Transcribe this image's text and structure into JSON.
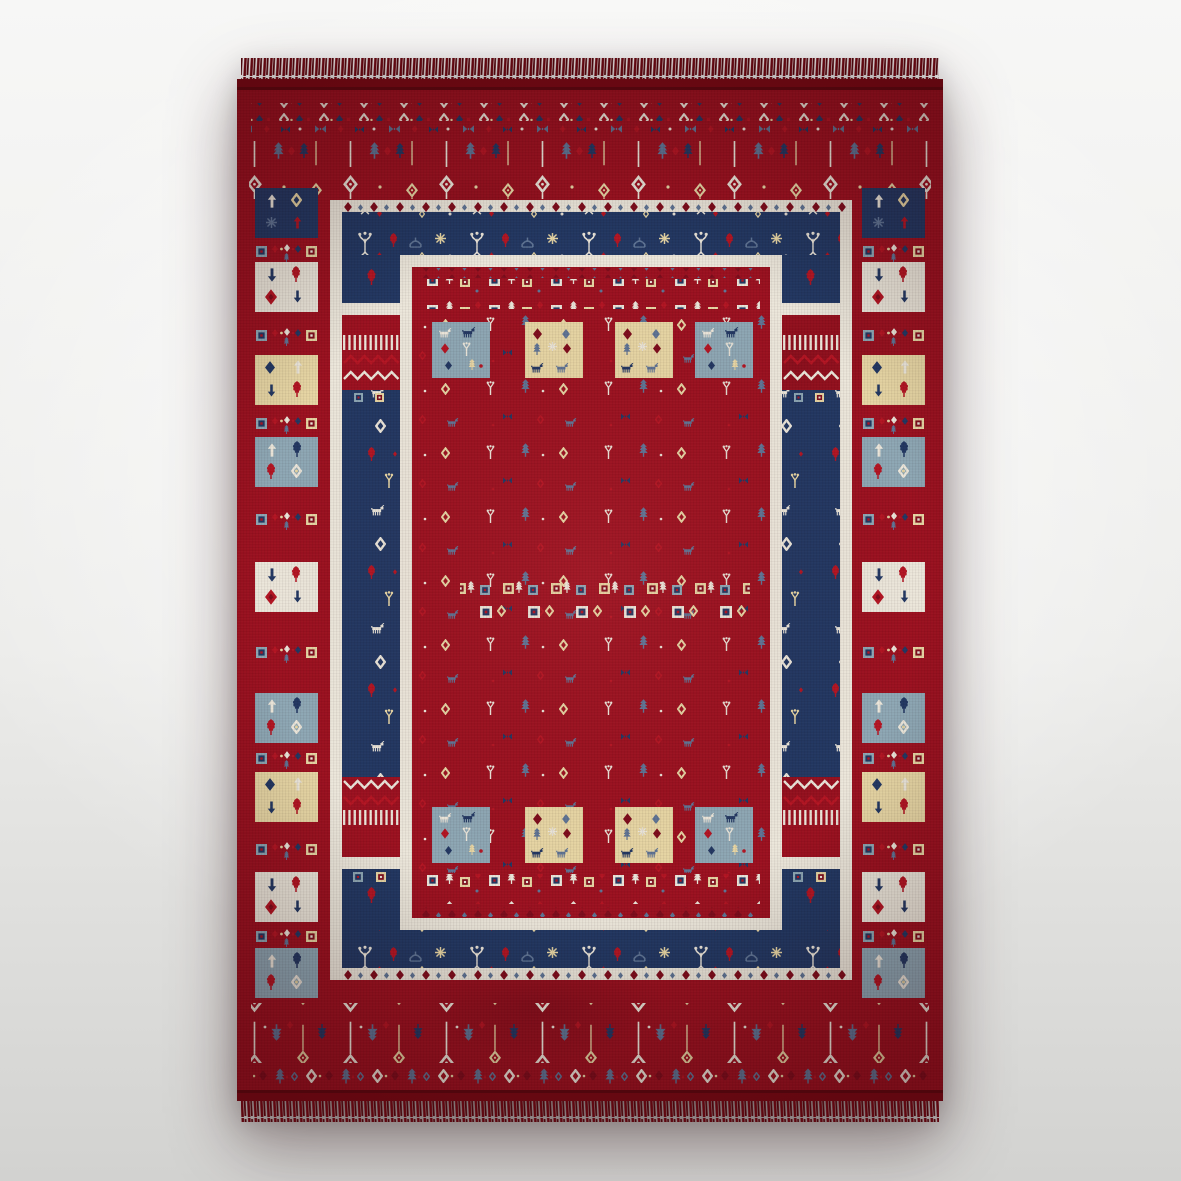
{
  "image": {
    "type": "product-photo",
    "subject": "Red gabbeh-style tribal area rug with navy stepped inner frame, patchwork side squares, animal and plant motifs, and fringed ends",
    "background": "light studio gradient backdrop"
  },
  "palette": {
    "bg_top": "#f7f7f6",
    "bg_mid": "#ececea",
    "bg_bottom": "#d2d2d0",
    "red": "#9c1120",
    "red_light": "#b02331",
    "red_deep": "#7c0b16",
    "maroon": "#7f0d1c",
    "navy": "#2238633",
    "ivory": "#ece7db",
    "cream": "#e8d7a5",
    "bluegray": "#8ea8b5",
    "slate": "#5f7596",
    "accent": "#b41523",
    "fringe": "#5f0710",
    "selvedge": "#7b0a15"
  },
  "rug": {
    "left_panel_squares": [
      "navy",
      "ivory",
      "cream",
      "blue-gray",
      "ivory",
      "blue-gray",
      "cream",
      "ivory",
      "blue-gray"
    ],
    "right_panel_squares": [
      "navy",
      "ivory",
      "cream",
      "blue-gray",
      "ivory",
      "blue-gray",
      "cream",
      "ivory",
      "blue-gray"
    ],
    "inner_top_squares": [
      "blue-gray",
      "cream",
      "cream",
      "blue-gray"
    ],
    "inner_bottom_squares": [
      "blue-gray",
      "cream",
      "cream",
      "blue-gray"
    ],
    "motifs": [
      "open-diamond",
      "solid-diamond",
      "pin-flower",
      "arrow-tree",
      "oak-leaf",
      "goat",
      "tulip",
      "candelabra",
      "bowtie",
      "comb-fringe",
      "zigzag",
      "concentric-square",
      "dome-tent",
      "snowflake"
    ],
    "fringe_sides": [
      "top",
      "bottom"
    ]
  }
}
